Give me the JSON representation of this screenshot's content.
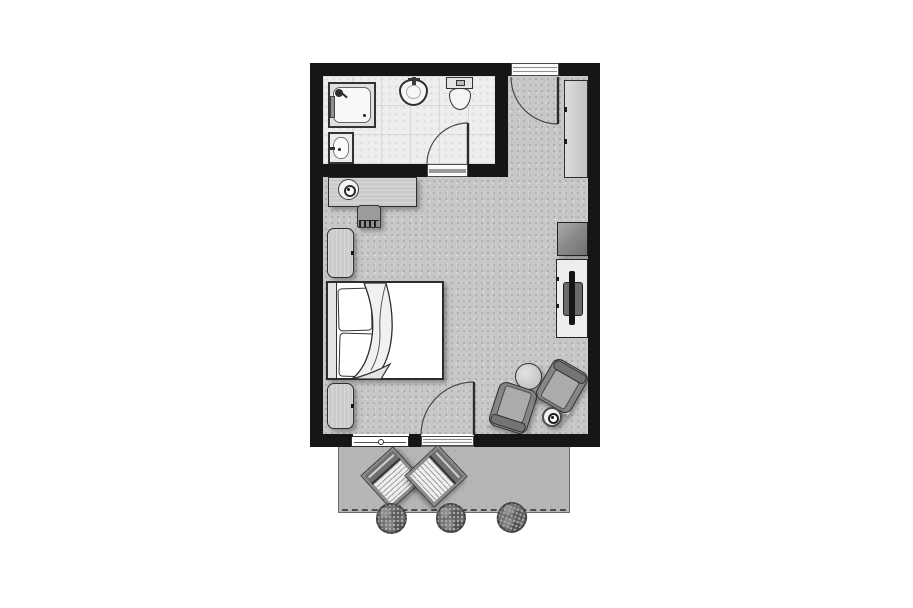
{
  "meta": {
    "type": "architectural floor plan",
    "description": "Top-down grayscale plan of a hotel guest room with en-suite bathroom and terrace",
    "visible_text": "none"
  },
  "colors": {
    "wall": "#161616",
    "room_floor": "#c7c7c7",
    "bath_floor": "#eeeeee",
    "tile_line": "#d8d8d8",
    "terrace": "#b6b6b6",
    "wood": "#cbcbcb",
    "chair": "#858585",
    "bed": "#ffffff",
    "outline": "#2e2e2e",
    "speckle_dark": "#a9a9a9",
    "speckle_light": "#dcdcdc"
  },
  "legend": {
    "plan": "Hotel room floor plan",
    "bathroom": "Bathroom",
    "bedroom": "Guest room",
    "terrace": "Terrace",
    "shower": "Shower",
    "washbasin": "Washbasin",
    "sink": "Sink",
    "toilet": "Toilet",
    "entry_door": "Entry door",
    "bathroom_door": "Bathroom door",
    "balcony_door": "Terrace door",
    "window": "Window",
    "wardrobe": "Wardrobe",
    "desk": "Desk console",
    "lamp": "Lamp",
    "desk_chair": "Desk chair",
    "nightstand": "Nightstand",
    "bed_label": "Double bed",
    "pillow": "Pillow",
    "blanket": "Folded blanket",
    "minibar": "Minibar",
    "tv_cabinet": "TV cabinet",
    "tv": "Television",
    "coffee_table": "Round table",
    "armchair": "Armchair",
    "side_table": "Side table",
    "sun_lounger": "Sun lounger",
    "shrub": "Shrub"
  }
}
